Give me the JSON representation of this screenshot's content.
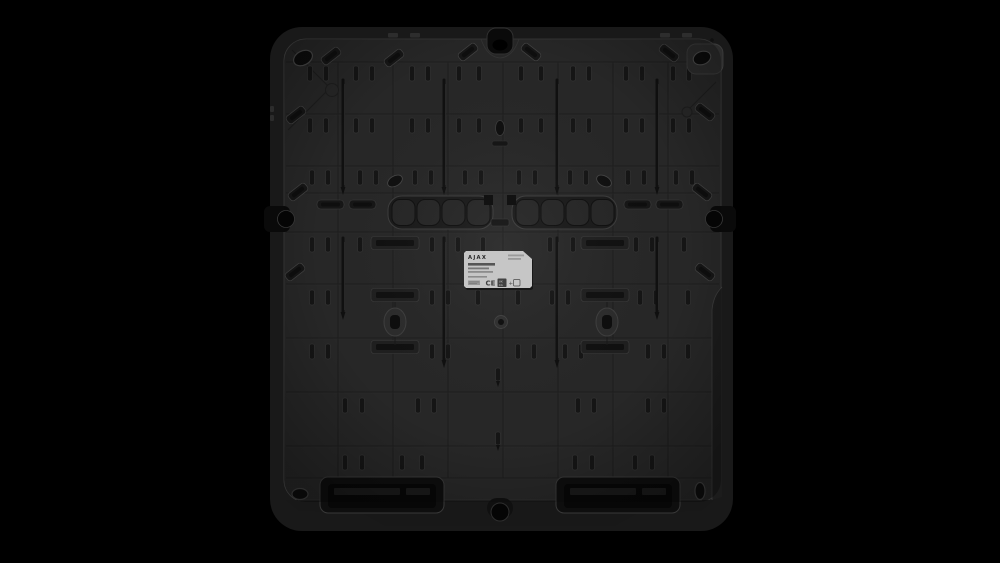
{
  "label": {
    "brand": "AJAX",
    "ce": "CE",
    "ukca_line1": "UK",
    "ukca_line2": "CA",
    "plus": "+"
  },
  "colors": {
    "background": "#000000",
    "panel_face": "#272727",
    "panel_rim": "#191919",
    "panel_edge_highlight": "#3a3a3a",
    "recess": "#141414",
    "hole": "#0a0a0a",
    "skirt": "#181818",
    "label_background": "#c6c6c6",
    "label_text": "#262626"
  }
}
